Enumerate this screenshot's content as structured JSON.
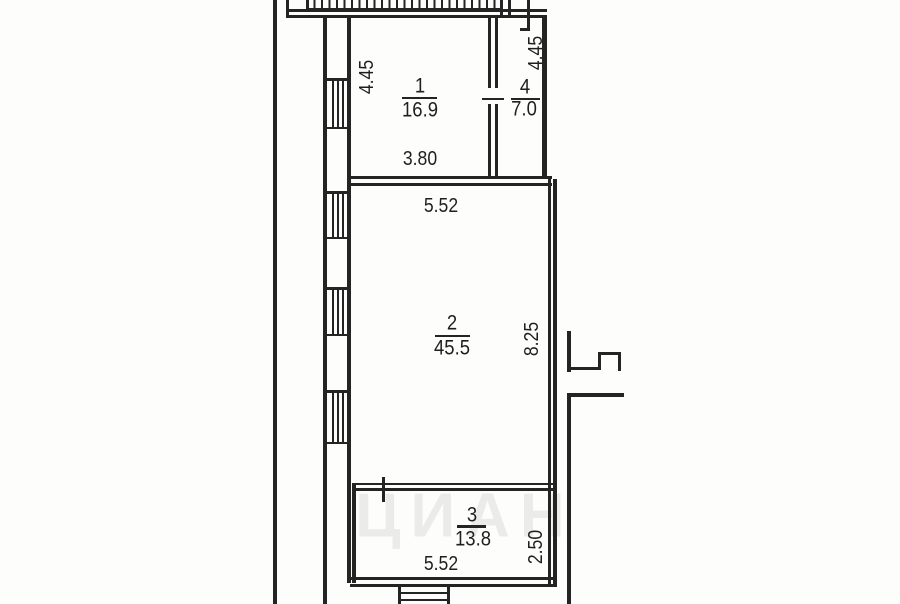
{
  "rooms": [
    {
      "number": "1",
      "area": "16.9"
    },
    {
      "number": "2",
      "area": "45.5"
    },
    {
      "number": "3",
      "area": "13.8"
    },
    {
      "number": "4",
      "area": "7.0"
    }
  ],
  "dimensions": [
    {
      "value": "4.45",
      "axis": "vertical",
      "position": "room-1-left"
    },
    {
      "value": "4.45",
      "axis": "vertical",
      "position": "room-4-right"
    },
    {
      "value": "3.80",
      "axis": "horizontal",
      "position": "room-1-bottom"
    },
    {
      "value": "5.52",
      "axis": "horizontal",
      "position": "room-2-top"
    },
    {
      "value": "8.25",
      "axis": "vertical",
      "position": "room-2-right"
    },
    {
      "value": "5.52",
      "axis": "horizontal",
      "position": "room-3-bottom"
    },
    {
      "value": "2.50",
      "axis": "vertical",
      "position": "room-3-right"
    }
  ],
  "watermark": {
    "text": "ЦИАН"
  },
  "colors": {
    "line": "#242424",
    "text": "#1f1f1f",
    "background": "#ffffff",
    "watermark": "rgba(0,0,0,0.07)"
  }
}
